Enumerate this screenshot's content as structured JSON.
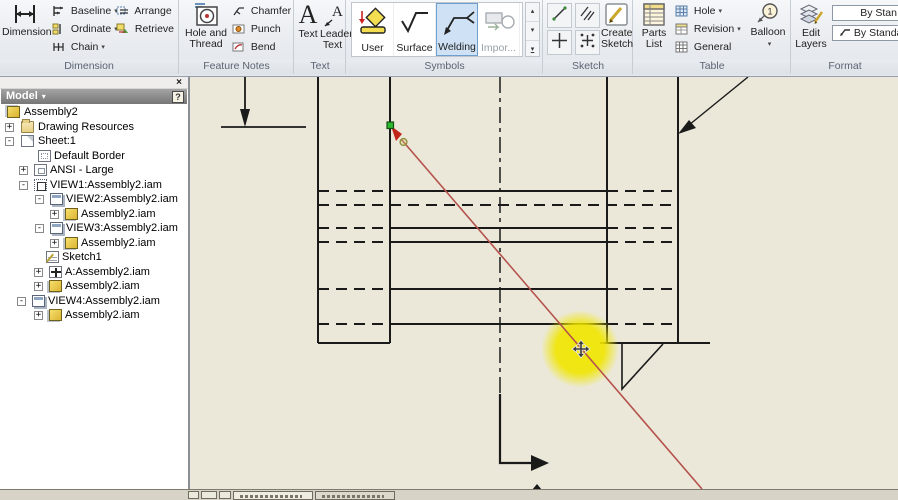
{
  "ui": {
    "caret_down": "▾",
    "caret_up": "▴",
    "gallery_more": "▾"
  },
  "ribbon": {
    "dimension": {
      "group_label": "Dimension",
      "big": "Dimension",
      "baseline": "Baseline",
      "ordinate": "Ordinate",
      "chain": "Chain",
      "arrange": "Arrange",
      "retrieve": "Retrieve"
    },
    "feature_notes": {
      "group_label": "Feature Notes",
      "big_line1": "Hole and",
      "big_line2": "Thread",
      "chamfer": "Chamfer",
      "punch": "Punch",
      "bend": "Bend"
    },
    "text": {
      "group_label": "Text",
      "text": "Text",
      "leader_line1": "Leader",
      "leader_line2": "Text"
    },
    "symbols": {
      "group_label": "Symbols",
      "user": "User",
      "surface": "Surface",
      "welding": "Welding",
      "import": "Impor...",
      "selected": "Welding"
    },
    "sketch": {
      "group_label": "Sketch",
      "create_line1": "Create",
      "create_line2": "Sketch"
    },
    "table": {
      "group_label": "Table",
      "parts_line1": "Parts",
      "parts_line2": "List",
      "hole": "Hole",
      "revision": "Revision",
      "general": "General",
      "balloon": "Balloon"
    },
    "format": {
      "group_label": "Format",
      "edit_line1": "Edit",
      "edit_line2": "Layers",
      "style_dropdown1": "By Stan",
      "style_dropdown2": "By Standar"
    }
  },
  "browser": {
    "title": "Model",
    "close": "×",
    "help": "?",
    "items": [
      {
        "label": "Assembly2",
        "expand": "",
        "icon": "assembly-icon"
      },
      {
        "label": "Drawing Resources",
        "expand": "+",
        "icon": "folder-icon"
      },
      {
        "label": "Sheet:1",
        "expand": "-",
        "icon": "sheet-icon"
      },
      {
        "label": "Default Border",
        "expand": "",
        "icon": "border-icon"
      },
      {
        "label": "ANSI - Large",
        "expand": "+",
        "icon": "titleblock-icon"
      },
      {
        "label": "VIEW1:Assembly2.iam",
        "expand": "-",
        "icon": "view1-icon"
      },
      {
        "label": "VIEW2:Assembly2.iam",
        "expand": "-",
        "icon": "view-icon"
      },
      {
        "label": "Assembly2.iam",
        "expand": "+",
        "icon": "assembly-file-icon"
      },
      {
        "label": "VIEW3:Assembly2.iam",
        "expand": "-",
        "icon": "view-icon"
      },
      {
        "label": "Assembly2.iam",
        "expand": "+",
        "icon": "assembly-file-icon"
      },
      {
        "label": "Sketch1",
        "expand": "",
        "icon": "sketch-icon"
      },
      {
        "label": "A:Assembly2.iam",
        "expand": "+",
        "icon": "section-view-icon"
      },
      {
        "label": "Assembly2.iam",
        "expand": "+",
        "icon": "assembly-file-icon"
      },
      {
        "label": "VIEW4:Assembly2.iam",
        "expand": "-",
        "icon": "view-icon"
      },
      {
        "label": "Assembly2.iam",
        "expand": "+",
        "icon": "assembly-file-icon"
      }
    ]
  },
  "canvas": {
    "sheet_color": "#ebe8da",
    "line_color": "#1a1a1a",
    "leader_preview_color": "#b5524c",
    "highlight_color": "#f0e600",
    "snap_point_color": "#2db82d"
  }
}
